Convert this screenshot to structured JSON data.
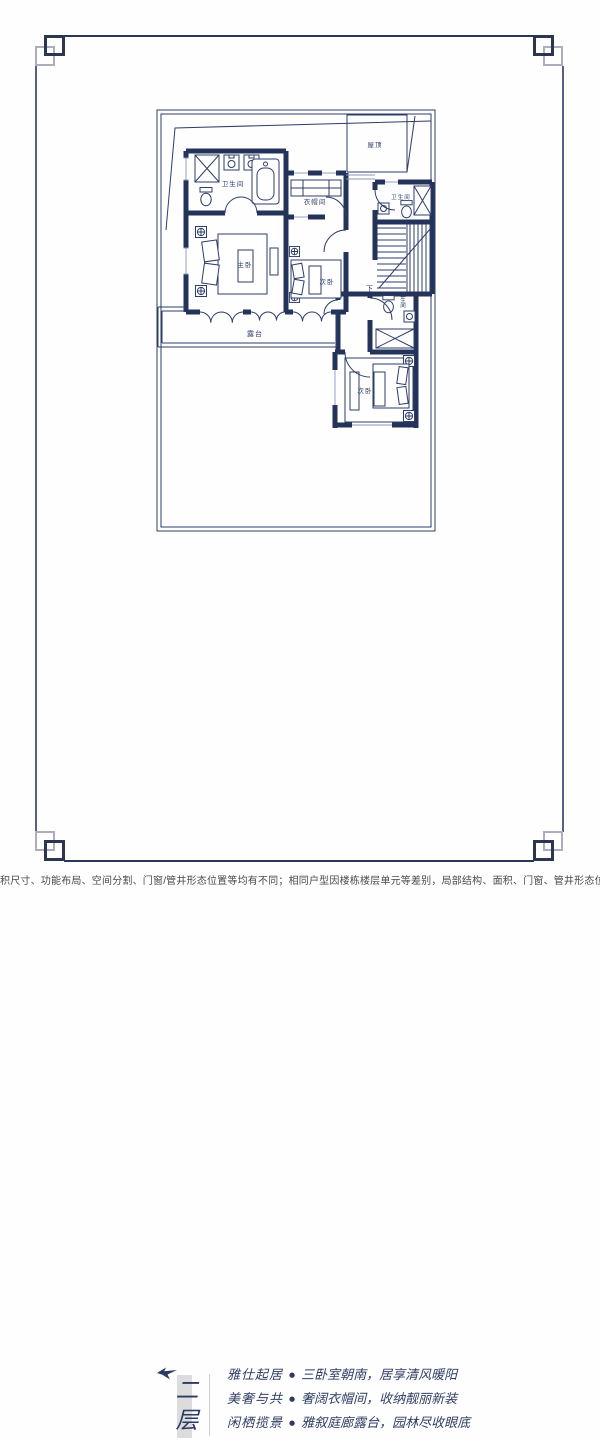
{
  "plan": {
    "labels": {
      "roof": "屋顶",
      "bath_top": "卫生间",
      "closet": "衣帽间",
      "bath_right": "卫生间",
      "master": "主卧",
      "bedroom_center": "次卧",
      "down": "下",
      "bath_lower": "卫生间",
      "terrace": "露台",
      "bedroom_lower": "次卧"
    }
  },
  "floor_section": {
    "floor_label": "二层",
    "bullet": "●",
    "features": [
      {
        "title": "雅仕起居",
        "desc": "三卧室朝南，居享清风暖阳"
      },
      {
        "title": "美奢与共",
        "desc": "奢阔衣帽间，收纳靓丽新装"
      },
      {
        "title": "闲栖揽景",
        "desc": "雅叙庭廊露台，园林尽收眼底"
      }
    ]
  },
  "disclaimer": "积尺寸、功能布局、空间分割、门窗/管井形态位置等均有不同；相同户型因楼栋楼层单元等差别，局部结构、面积、门窗、管井形态位置等也可能不同；具体每户的",
  "colors": {
    "navy": "#24335a",
    "frame_light": "#aeadc0",
    "bar_gray": "#dcdcdc"
  }
}
